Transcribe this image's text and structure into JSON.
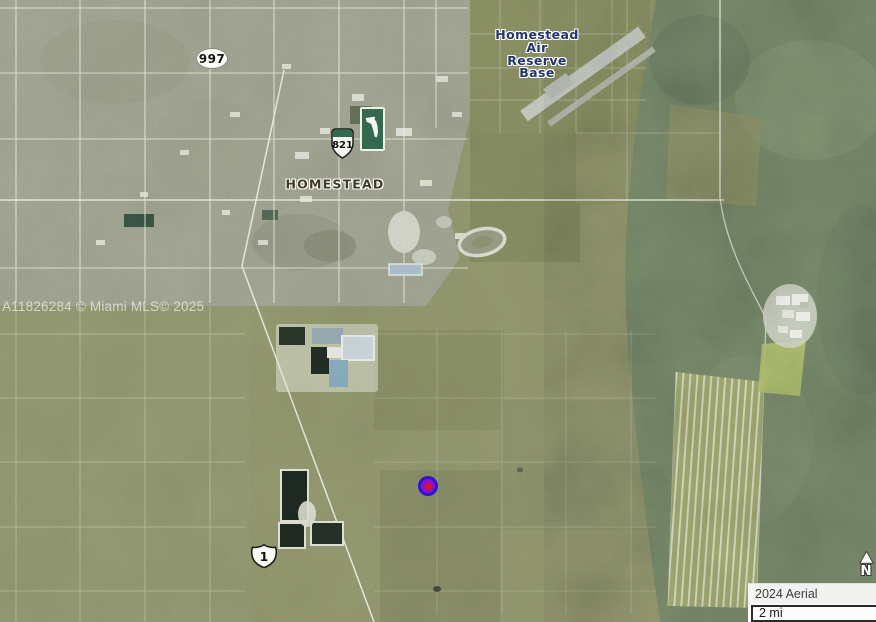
{
  "map": {
    "labels": {
      "city": "HOMESTEAD",
      "airbase_lines": [
        "Homestead",
        "Air",
        "Reserve",
        "Base"
      ],
      "watermark": "A11826284 © Miami MLS© 2025"
    },
    "shields": {
      "sr997": {
        "number": "997"
      },
      "turnpike821": {
        "number": "821"
      },
      "us1": {
        "number": "1"
      }
    },
    "marker": {
      "outer_color": "#2a17cf",
      "middle_color": "#8c11c4",
      "inner_color": "#df1038"
    },
    "compass_north": "N",
    "attribution": {
      "credit": "2024 Aerial Photography",
      "scale": "2 mi"
    },
    "label_colors": {
      "city": "#3f3a22",
      "airbase": "#23356e"
    }
  }
}
